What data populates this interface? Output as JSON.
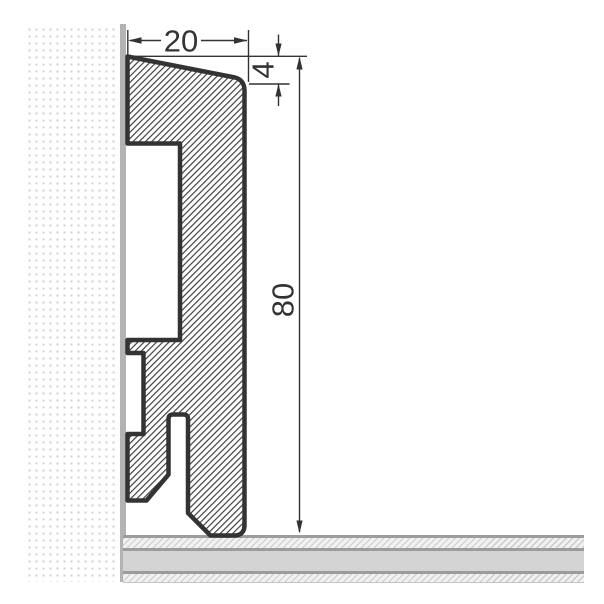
{
  "drawing": {
    "labels": {
      "width": "20",
      "top_edge": "4",
      "height": "80"
    },
    "colors": {
      "outline": "#333333",
      "hatch_line": "#3a3a3a",
      "wall_dots": "#d4d4d4",
      "wall_strip": "#b3b3b3",
      "floor_core": "#d4d4d4",
      "floor_hatch_bg": "#f1f1f1",
      "floor_hatch_line": "#cbcbcb",
      "floor_separator": "#9c9c9c",
      "background": "#ffffff"
    }
  }
}
